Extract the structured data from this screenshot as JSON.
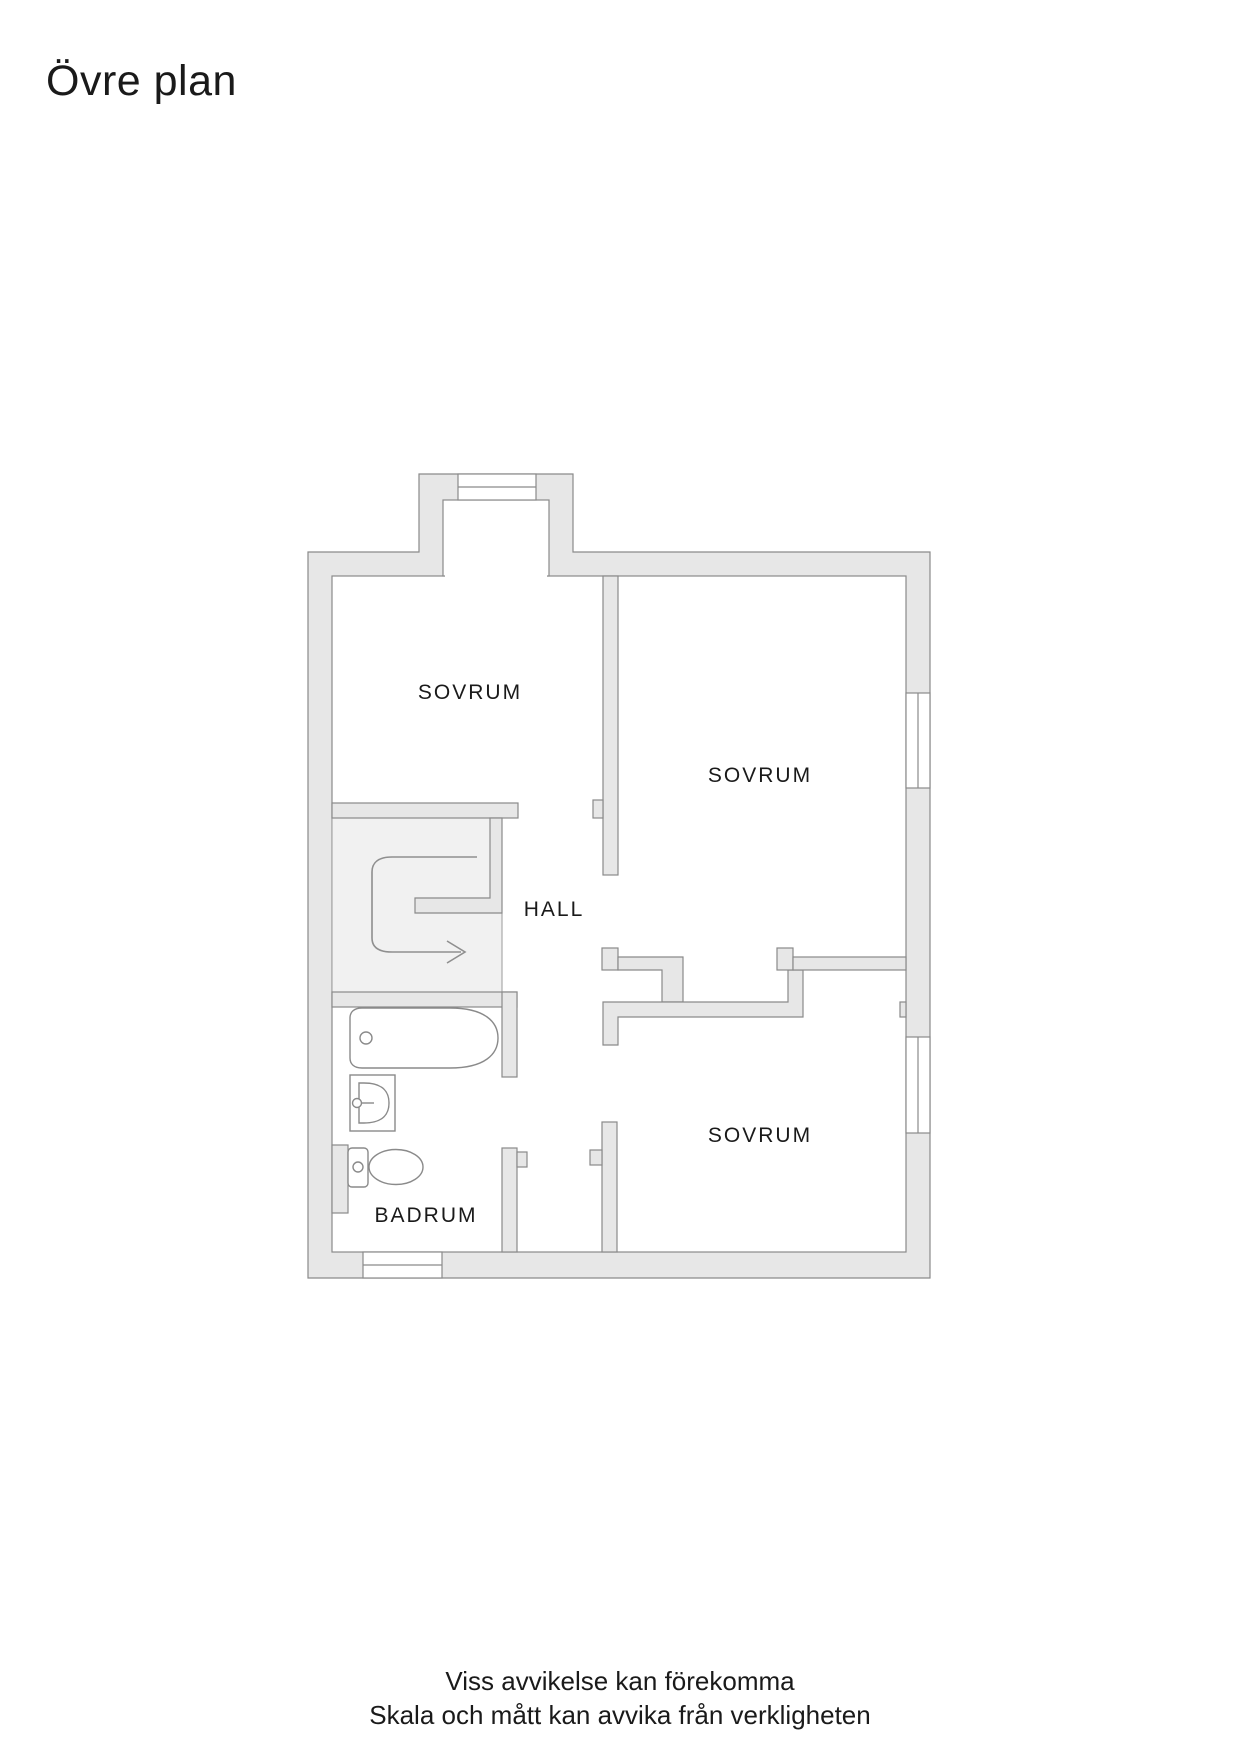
{
  "title": "Övre plan",
  "rooms": [
    {
      "id": "sovrum-top-left",
      "label": "SOVRUM"
    },
    {
      "id": "sovrum-right",
      "label": "SOVRUM"
    },
    {
      "id": "hall",
      "label": "HALL"
    },
    {
      "id": "sovrum-bottom",
      "label": "SOVRUM"
    },
    {
      "id": "badrum",
      "label": "BADRUM"
    }
  ],
  "footer": {
    "line1": "Viss avvikelse kan förekomma",
    "line2": "Skala och mått kan avvika från verkligheten"
  },
  "colors": {
    "page-bg": "#ffffff",
    "wall-fill": "#e7e7e7",
    "wall-stroke": "#8a8a8a",
    "stair-fill": "#f1f1f1",
    "fixture-stroke": "#8a8a8a",
    "text": "#1a1a1a"
  },
  "icons": {
    "windows": "window-icon",
    "bathtub": "bathtub-icon",
    "sink": "sink-icon",
    "toilet": "toilet-icon",
    "stairs": "stairs-up-arrow-icon"
  }
}
